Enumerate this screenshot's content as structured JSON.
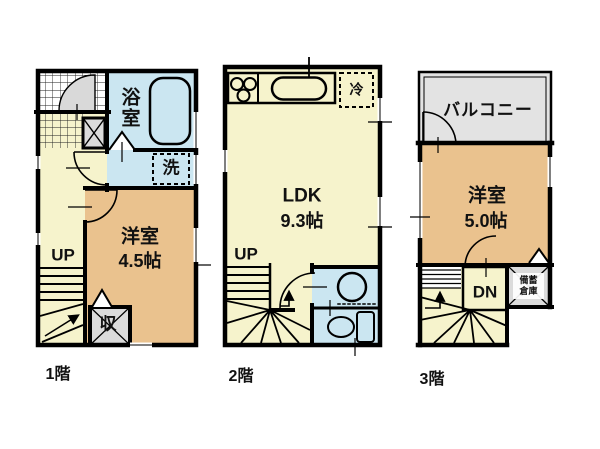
{
  "colors": {
    "wall": "#000000",
    "hall_yellow": "#F6F3CC",
    "room_tan": "#EAC28E",
    "wet_blue": "#CBE6F1",
    "balcony_gray": "#E3E3E3",
    "closet_gray": "#DBDBDB",
    "door_gray": "#D9D9D9",
    "text": "#111111"
  },
  "floor1": {
    "floor_label": "1階",
    "bath": "浴室",
    "laundry": "洗",
    "room": "洋室",
    "room_size": "4.5帖",
    "stairs": "UP",
    "closet": "収"
  },
  "floor2": {
    "floor_label": "2階",
    "ldk": "LDK",
    "ldk_size": "9.3帖",
    "fridge": "冷",
    "stairs": "UP"
  },
  "floor3": {
    "floor_label": "3階",
    "balcony": "バルコニー",
    "room": "洋室",
    "room_size": "5.0帖",
    "stairs": "DN",
    "storage_line1": "備蓄",
    "storage_line2": "倉庫"
  }
}
